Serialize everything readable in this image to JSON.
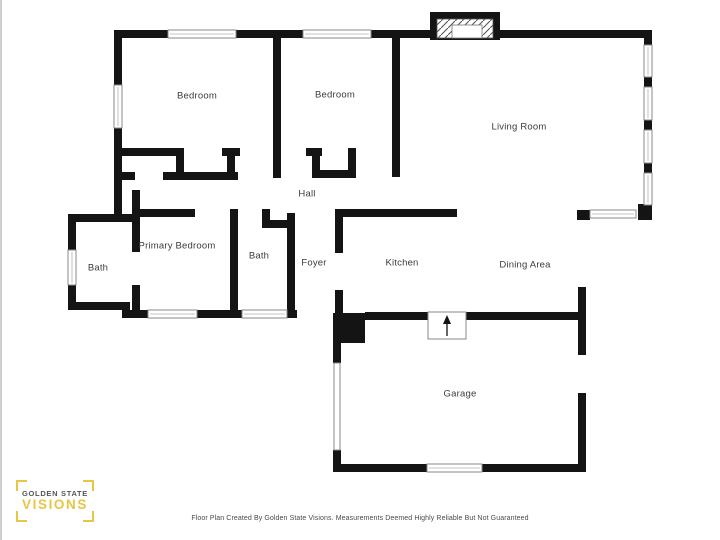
{
  "rooms": [
    {
      "id": "bedroom-1",
      "label": "Bedroom"
    },
    {
      "id": "bedroom-2",
      "label": "Bedroom"
    },
    {
      "id": "living-room",
      "label": "Living Room"
    },
    {
      "id": "hall",
      "label": "Hall"
    },
    {
      "id": "primary-bedroom",
      "label": "Primary Bedroom"
    },
    {
      "id": "bath-left",
      "label": "Bath"
    },
    {
      "id": "bath-middle",
      "label": "Bath"
    },
    {
      "id": "foyer",
      "label": "Foyer"
    },
    {
      "id": "kitchen",
      "label": "Kitchen"
    },
    {
      "id": "dining-area",
      "label": "Dining Area"
    },
    {
      "id": "garage",
      "label": "Garage"
    }
  ],
  "branding": {
    "logo_line1": "GOLDEN STATE",
    "logo_line2": "VISIONS",
    "logo_text_color": "#54565A",
    "logo_accent_color": "#E8C544"
  },
  "footer": {
    "disclaimer": "Floor Plan Created By Golden State Visions. Measurements Deemed Highly Reliable But Not Guaranteed"
  },
  "colors": {
    "wall": "#141414",
    "label_text": "#3B3B3B",
    "window_frame": "#8A8A8A"
  }
}
